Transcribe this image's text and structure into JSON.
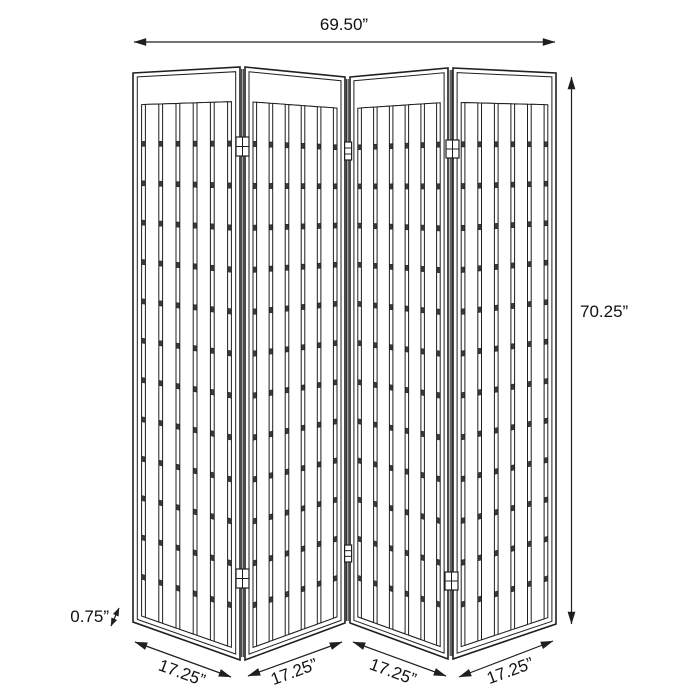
{
  "diagram": {
    "type": "furniture-dimension-drawing",
    "subject": "4-panel shoji-style folding room divider screen",
    "colors": {
      "background": "#ffffff",
      "line": "#1f1f1f",
      "rail_fill": "#3b3b3b",
      "text": "#111111"
    },
    "panel_count": 4,
    "lattice": {
      "slats_per_panel": 5,
      "rails_per_panel": 12
    },
    "dimensions": {
      "overall_width": {
        "label": "69.50”"
      },
      "overall_height": {
        "label": "70.25”"
      },
      "panel_widths": [
        {
          "label": "17.25”"
        },
        {
          "label": "17.25”"
        },
        {
          "label": "17.25”"
        },
        {
          "label": "17.25”"
        }
      ],
      "panel_thickness": {
        "label": "0.75”"
      }
    },
    "geometry": {
      "panels": [
        {
          "tl": [
            133,
            73
          ],
          "tr": [
            240,
            67
          ],
          "br": [
            240,
            660
          ],
          "bl": [
            133,
            622
          ]
        },
        {
          "tl": [
            245,
            67
          ],
          "tr": [
            345,
            77
          ],
          "br": [
            345,
            623
          ],
          "bl": [
            245,
            660
          ]
        },
        {
          "tl": [
            350,
            77
          ],
          "tr": [
            448,
            68
          ],
          "br": [
            448,
            659
          ],
          "bl": [
            350,
            623
          ]
        },
        {
          "tl": [
            453,
            68
          ],
          "tr": [
            556,
            73
          ],
          "br": [
            556,
            624
          ],
          "bl": [
            453,
            659
          ]
        }
      ],
      "fractions": {
        "edge_u": 0.04,
        "edge_v": 0.0075,
        "u_frame": 0.08,
        "v_top": 0.058,
        "v_bottom": 0.9836,
        "gap": 0.036,
        "slat": 0.1248,
        "rail_half": 0.0046
      },
      "gap_lines": [
        [
          241.7,
          69,
          241.7,
          657
        ],
        [
          243.3,
          69,
          243.3,
          657
        ],
        [
          346.6,
          79,
          346.6,
          621
        ],
        [
          348.2,
          79,
          348.2,
          621
        ],
        [
          450.2,
          70,
          450.2,
          656
        ],
        [
          451.8,
          70,
          451.8,
          656
        ]
      ],
      "hinges": [
        {
          "style": "grid",
          "x": 236.0,
          "y": 137,
          "w": 13,
          "h": 19
        },
        {
          "style": "grid",
          "x": 236.0,
          "y": 569,
          "w": 13,
          "h": 19
        },
        {
          "style": "grid",
          "x": 446.0,
          "y": 140,
          "w": 13,
          "h": 18
        },
        {
          "style": "grid",
          "x": 445.0,
          "y": 572,
          "w": 13,
          "h": 18
        },
        {
          "style": "narrow",
          "x": 344.6,
          "y": 142,
          "w": 7,
          "h": 18
        },
        {
          "style": "narrow",
          "x": 344.6,
          "y": 545,
          "w": 7,
          "h": 17
        }
      ]
    }
  }
}
